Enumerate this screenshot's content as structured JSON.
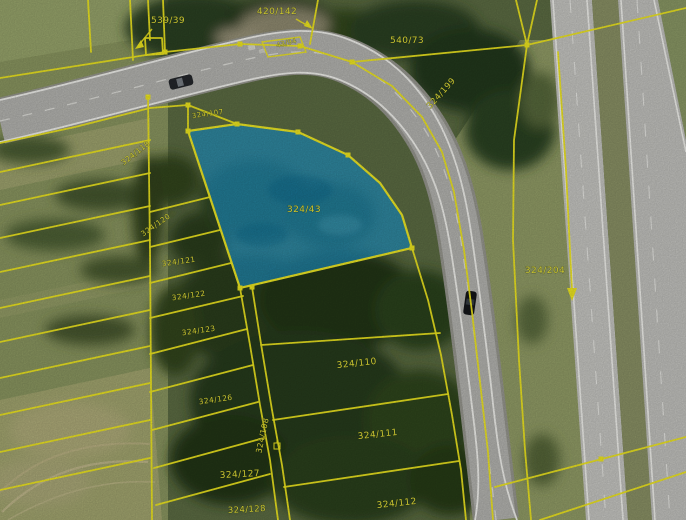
{
  "app": {
    "title": "Cadastral parcel map over aerial imagery"
  },
  "map": {
    "colors": {
      "parcel_line": "#efe71f",
      "label_text": "#ece63a",
      "highlight_fill": "#1e91c3",
      "highlight_border": "#eee825"
    },
    "highlighted_parcel": {
      "id": "324/43"
    },
    "parcel_labels": [
      {
        "id": "539/39",
        "x": 168,
        "y": 23,
        "rot": 0,
        "size": 9
      },
      {
        "id": "420/142",
        "x": 277,
        "y": 14,
        "rot": 0,
        "size": 9
      },
      {
        "id": "43/94",
        "x": 287,
        "y": 45,
        "rot": -14,
        "size": 6.5
      },
      {
        "id": "540/73",
        "x": 407,
        "y": 43,
        "rot": 0,
        "size": 9
      },
      {
        "id": "324/199",
        "x": 443,
        "y": 95,
        "rot": -48,
        "size": 8.5
      },
      {
        "id": "324/107",
        "x": 208,
        "y": 116,
        "rot": -8,
        "size": 7
      },
      {
        "id": "324/43",
        "x": 304,
        "y": 212,
        "rot": 0,
        "size": 9
      },
      {
        "id": "324/118",
        "x": 137,
        "y": 155,
        "rot": -38,
        "size": 7.5
      },
      {
        "id": "324/120",
        "x": 157,
        "y": 227,
        "rot": -35,
        "size": 7.5
      },
      {
        "id": "324/121",
        "x": 179,
        "y": 264,
        "rot": -8,
        "size": 7.5
      },
      {
        "id": "324/122",
        "x": 189,
        "y": 298,
        "rot": -8,
        "size": 7.5
      },
      {
        "id": "324/123",
        "x": 199,
        "y": 333,
        "rot": -8,
        "size": 7.5
      },
      {
        "id": "324/126",
        "x": 216,
        "y": 402,
        "rot": -8,
        "size": 7.5
      },
      {
        "id": "324/127",
        "x": 240,
        "y": 477,
        "rot": -3,
        "size": 9
      },
      {
        "id": "324/128",
        "x": 247,
        "y": 512,
        "rot": -3,
        "size": 8.5
      },
      {
        "id": "324/108",
        "x": 265,
        "y": 436,
        "rot": -78,
        "size": 8
      },
      {
        "id": "324/110",
        "x": 357,
        "y": 366,
        "rot": -6,
        "size": 9
      },
      {
        "id": "324/111",
        "x": 378,
        "y": 437,
        "rot": -6,
        "size": 9
      },
      {
        "id": "324/112",
        "x": 397,
        "y": 506,
        "rot": -6,
        "size": 9
      },
      {
        "id": "324/204",
        "x": 545,
        "y": 273,
        "rot": 0,
        "size": 9
      }
    ],
    "annotations": {
      "leader_arrows_for": [
        "539/39",
        "420/142"
      ],
      "boundary_arrow_near_parcel": "324/204"
    },
    "features": {
      "vehicles": [
        "dark car on local road (upper left)",
        "dark car on local road (right curve)"
      ],
      "roads": [
        "curved two-lane local road",
        "dual-carriageway highway on right"
      ]
    }
  }
}
